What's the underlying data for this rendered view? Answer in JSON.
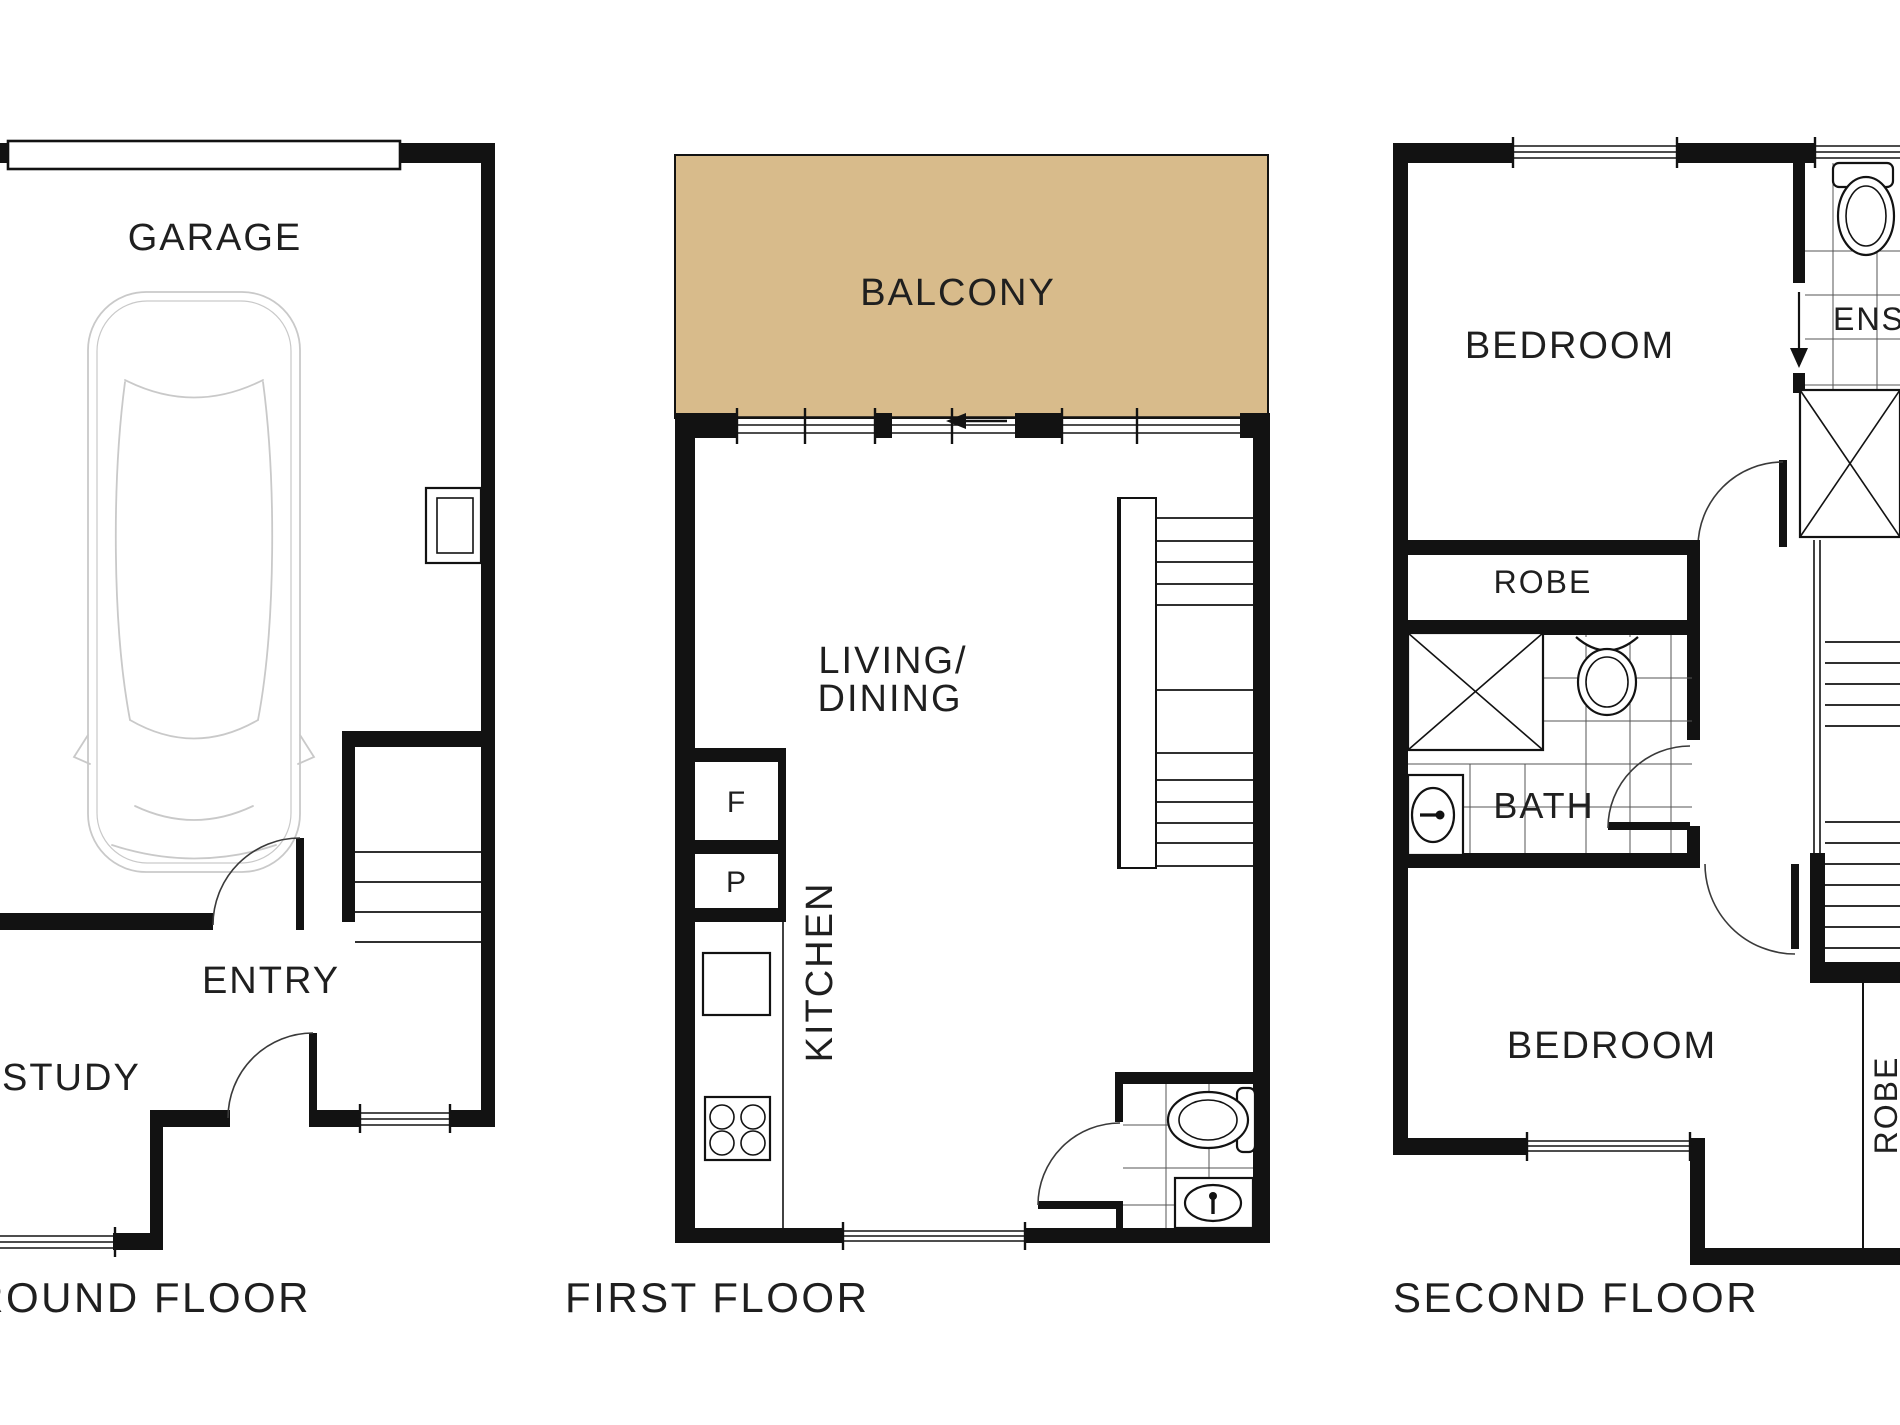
{
  "colors": {
    "balcony_fill": "#d8bb8b",
    "wall": "#121212",
    "text": "#1f1f1f",
    "car_outline": "#c9c9c9"
  },
  "floors": {
    "ground": {
      "label": "GROUND FLOOR",
      "rooms": {
        "garage": "GARAGE",
        "entry": "ENTRY",
        "study": "STUDY"
      }
    },
    "first": {
      "label": "FIRST FLOOR",
      "rooms": {
        "balcony": "BALCONY",
        "living_line1": "LIVING/",
        "living_line2": "DINING",
        "kitchen": "KITCHEN",
        "fridge": "F",
        "pantry": "P"
      }
    },
    "second": {
      "label": "SECOND FLOOR",
      "rooms": {
        "bedroom_front": "BEDROOM",
        "bedroom_rear": "BEDROOM",
        "ensuite": "ENSUITE",
        "robe_hall": "ROBE",
        "robe_builtin": "ROBE",
        "bath": "BATH"
      }
    }
  }
}
